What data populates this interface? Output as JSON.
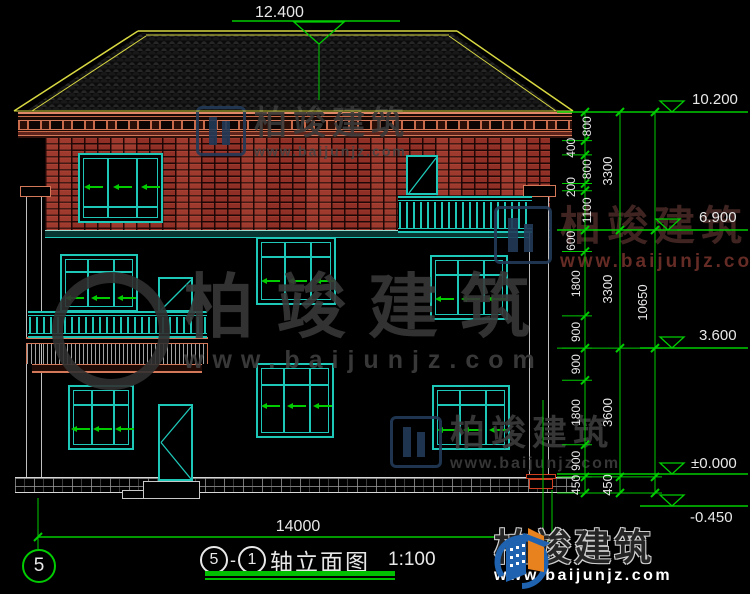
{
  "title": {
    "bubble_left": "5",
    "dash": "-",
    "bubble_right": "1",
    "label": "轴立面图",
    "scale": "1:100"
  },
  "axis": {
    "left_bubble": "5"
  },
  "dimensions": {
    "top_elevation": "12.400",
    "bottom_width": "14000",
    "chain1": [
      "800",
      "400",
      "800",
      "200",
      "1100",
      "600",
      "1800",
      "900",
      "900",
      "1800",
      "900",
      "450"
    ],
    "chain2": [
      "3300",
      "3300",
      "3600",
      "450"
    ],
    "chain3": [
      "10650"
    ],
    "elevations": [
      "10.200",
      "6.900",
      "3.600",
      "±0.000",
      "-0.450"
    ]
  },
  "watermark": {
    "brand": "柏竣建筑",
    "url": "www.baijunjz.com"
  },
  "logo": {
    "brand": "柏竣建筑",
    "url": "www.baijunjz.com"
  },
  "colors": {
    "dim_green": "#00cc00",
    "frame_teal": "#1ec8b8",
    "roof_yellow": "#d8d842",
    "brick_red": "#8f2f26",
    "cornice_pink": "#d4785a",
    "logo_blue": "#1e62b0",
    "logo_orange": "#e8821e"
  }
}
